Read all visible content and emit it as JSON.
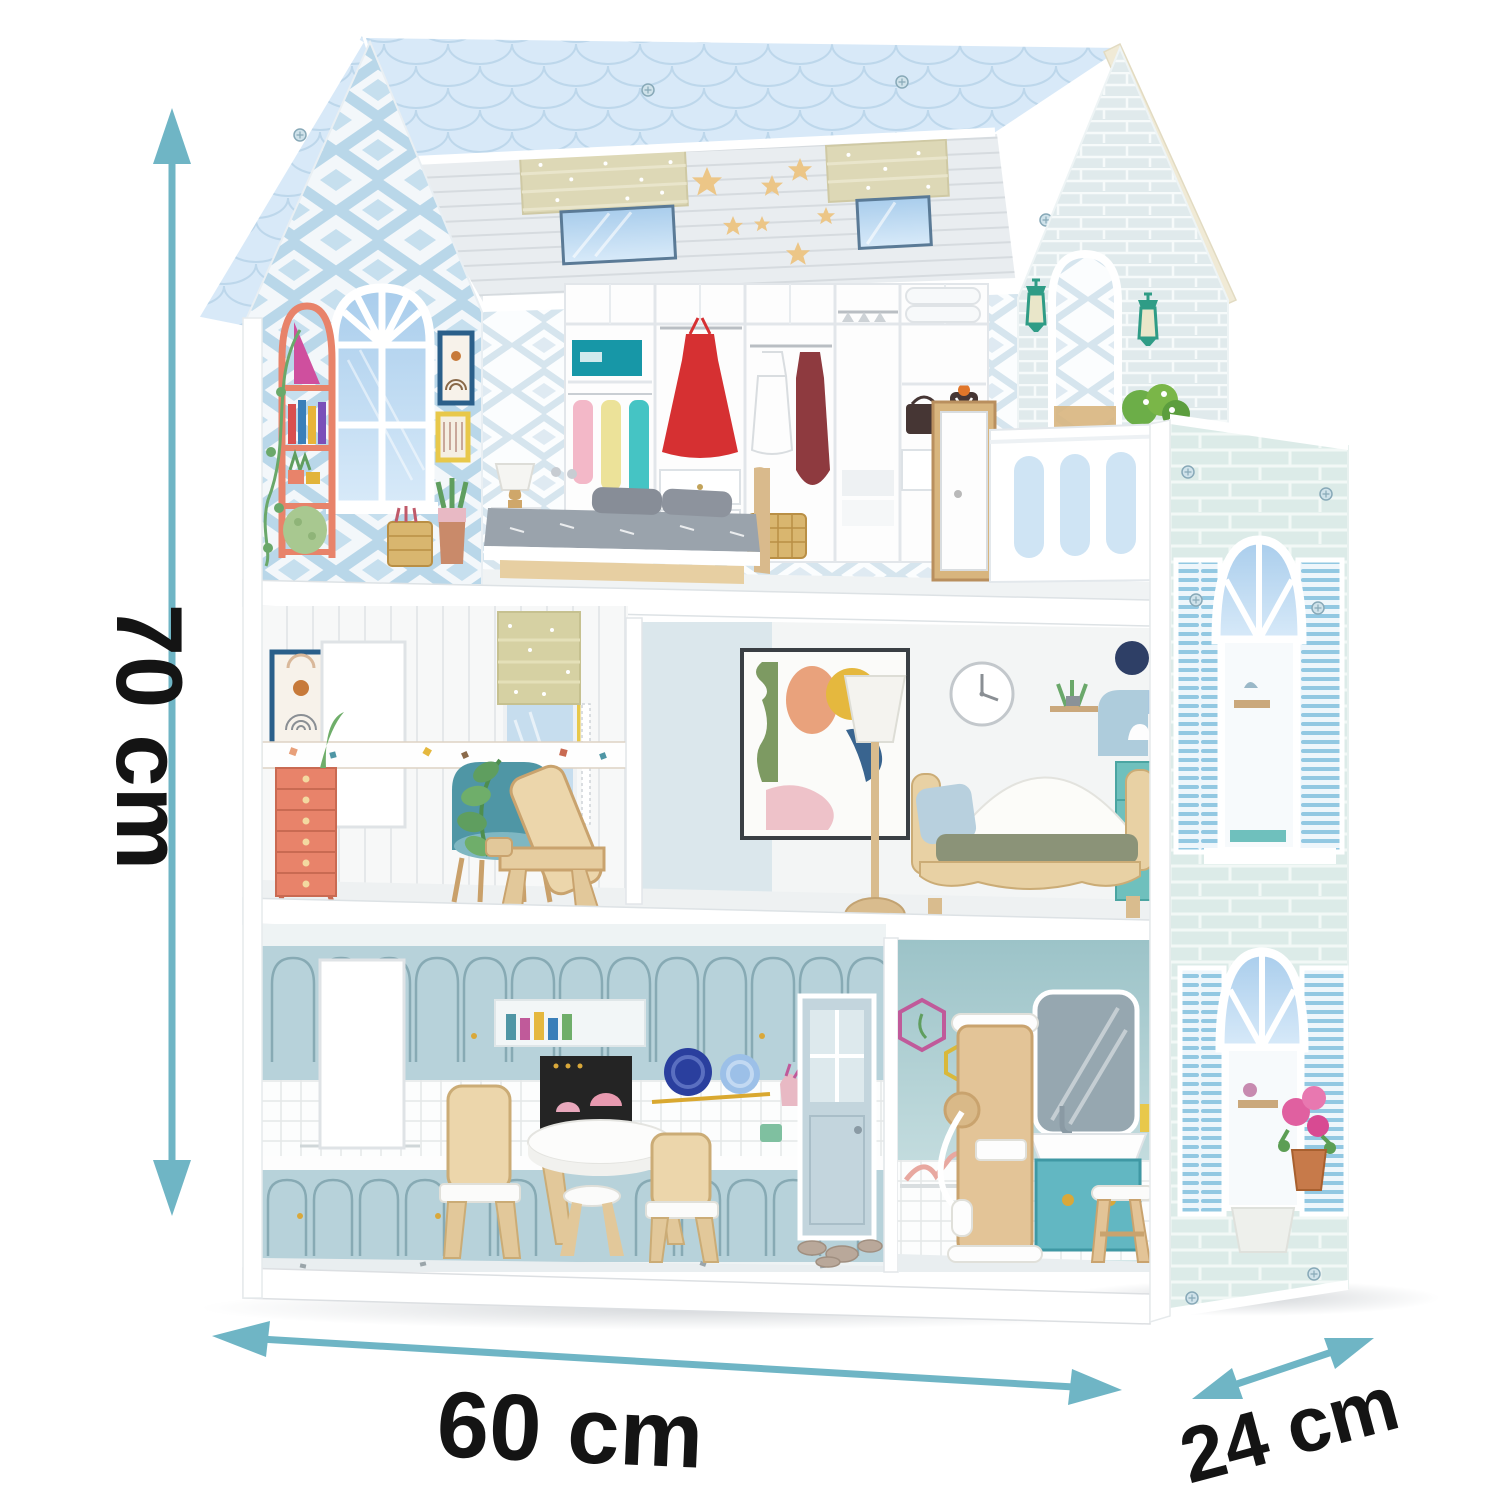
{
  "dimensions": {
    "height": "70 cm",
    "width": "60 cm",
    "depth": "24 cm"
  },
  "annotation": {
    "arrow_color": "#6FB5C5",
    "text_color": "#141414"
  },
  "palette": {
    "roof_shingles": "#D8E9F8",
    "gable_wallpaper_blue": "#BCD9EA",
    "side_wall_brick": "#DCEBE8",
    "kitchen_cabinets": "#B7D2DA",
    "bathroom_wall": "#A7C9CD",
    "wood_toy": "#E3C497",
    "coral_accent": "#E8836A",
    "teal_accent": "#4F96A5",
    "red_dress": "#D63032",
    "olive_cushion": "#8B9378"
  }
}
